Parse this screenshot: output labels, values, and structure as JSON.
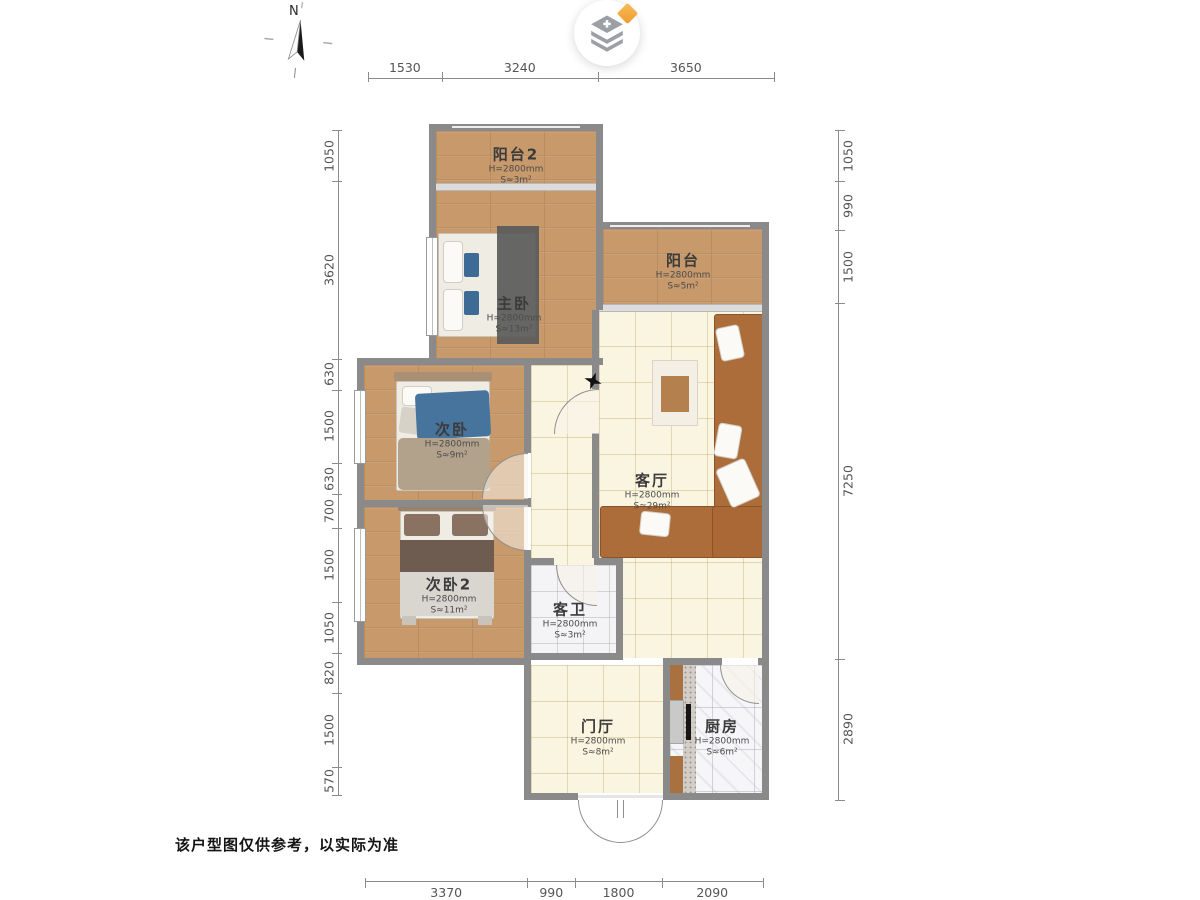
{
  "compass": {
    "label": "N"
  },
  "watermark": {
    "icon": "stacked-layers-icon",
    "badge": "gem-icon",
    "plus_glyph": "+"
  },
  "dimensions": {
    "top": [
      1530,
      3240,
      3650
    ],
    "bottom": [
      3370,
      990,
      1800,
      2090
    ],
    "left": [
      1050,
      3620,
      630,
      1500,
      630,
      700,
      1500,
      1050,
      820,
      1500,
      570
    ],
    "right": [
      1050,
      990,
      1500,
      7250,
      2890
    ]
  },
  "rooms": [
    {
      "id": "balcony2",
      "name": "阳台2",
      "height": "H=2800mm",
      "area": "S≈3m²"
    },
    {
      "id": "master",
      "name": "主卧",
      "height": "H=2800mm",
      "area": "S≈13m²"
    },
    {
      "id": "balcony",
      "name": "阳台",
      "height": "H=2800mm",
      "area": "S≈5m²"
    },
    {
      "id": "bedroom2",
      "name": "次卧",
      "height": "H=2800mm",
      "area": "S≈9m²"
    },
    {
      "id": "living",
      "name": "客厅",
      "height": "H=2800mm",
      "area": "S≈29m²"
    },
    {
      "id": "bedroom3",
      "name": "次卧2",
      "height": "H=2800mm",
      "area": "S≈11m²"
    },
    {
      "id": "bath",
      "name": "客卫",
      "height": "H=2800mm",
      "area": "S≈3m²"
    },
    {
      "id": "foyer",
      "name": "门厅",
      "height": "H=2800mm",
      "area": "S≈8m²"
    },
    {
      "id": "kitchen",
      "name": "厨房",
      "height": "H=2800mm",
      "area": "S≈6m²"
    }
  ],
  "disclaimer": "该户型图仅供参考，以实际为准",
  "colors": {
    "wall": "#8a8a8a",
    "wood_floor": "#c7996b",
    "cream_tile": "#faf5e0",
    "sofa_brown": "#ad6d3a",
    "pillow_blue": "#3e6b96",
    "diamond_orange": "#ef9b2d",
    "dimension_text": "#555555"
  }
}
